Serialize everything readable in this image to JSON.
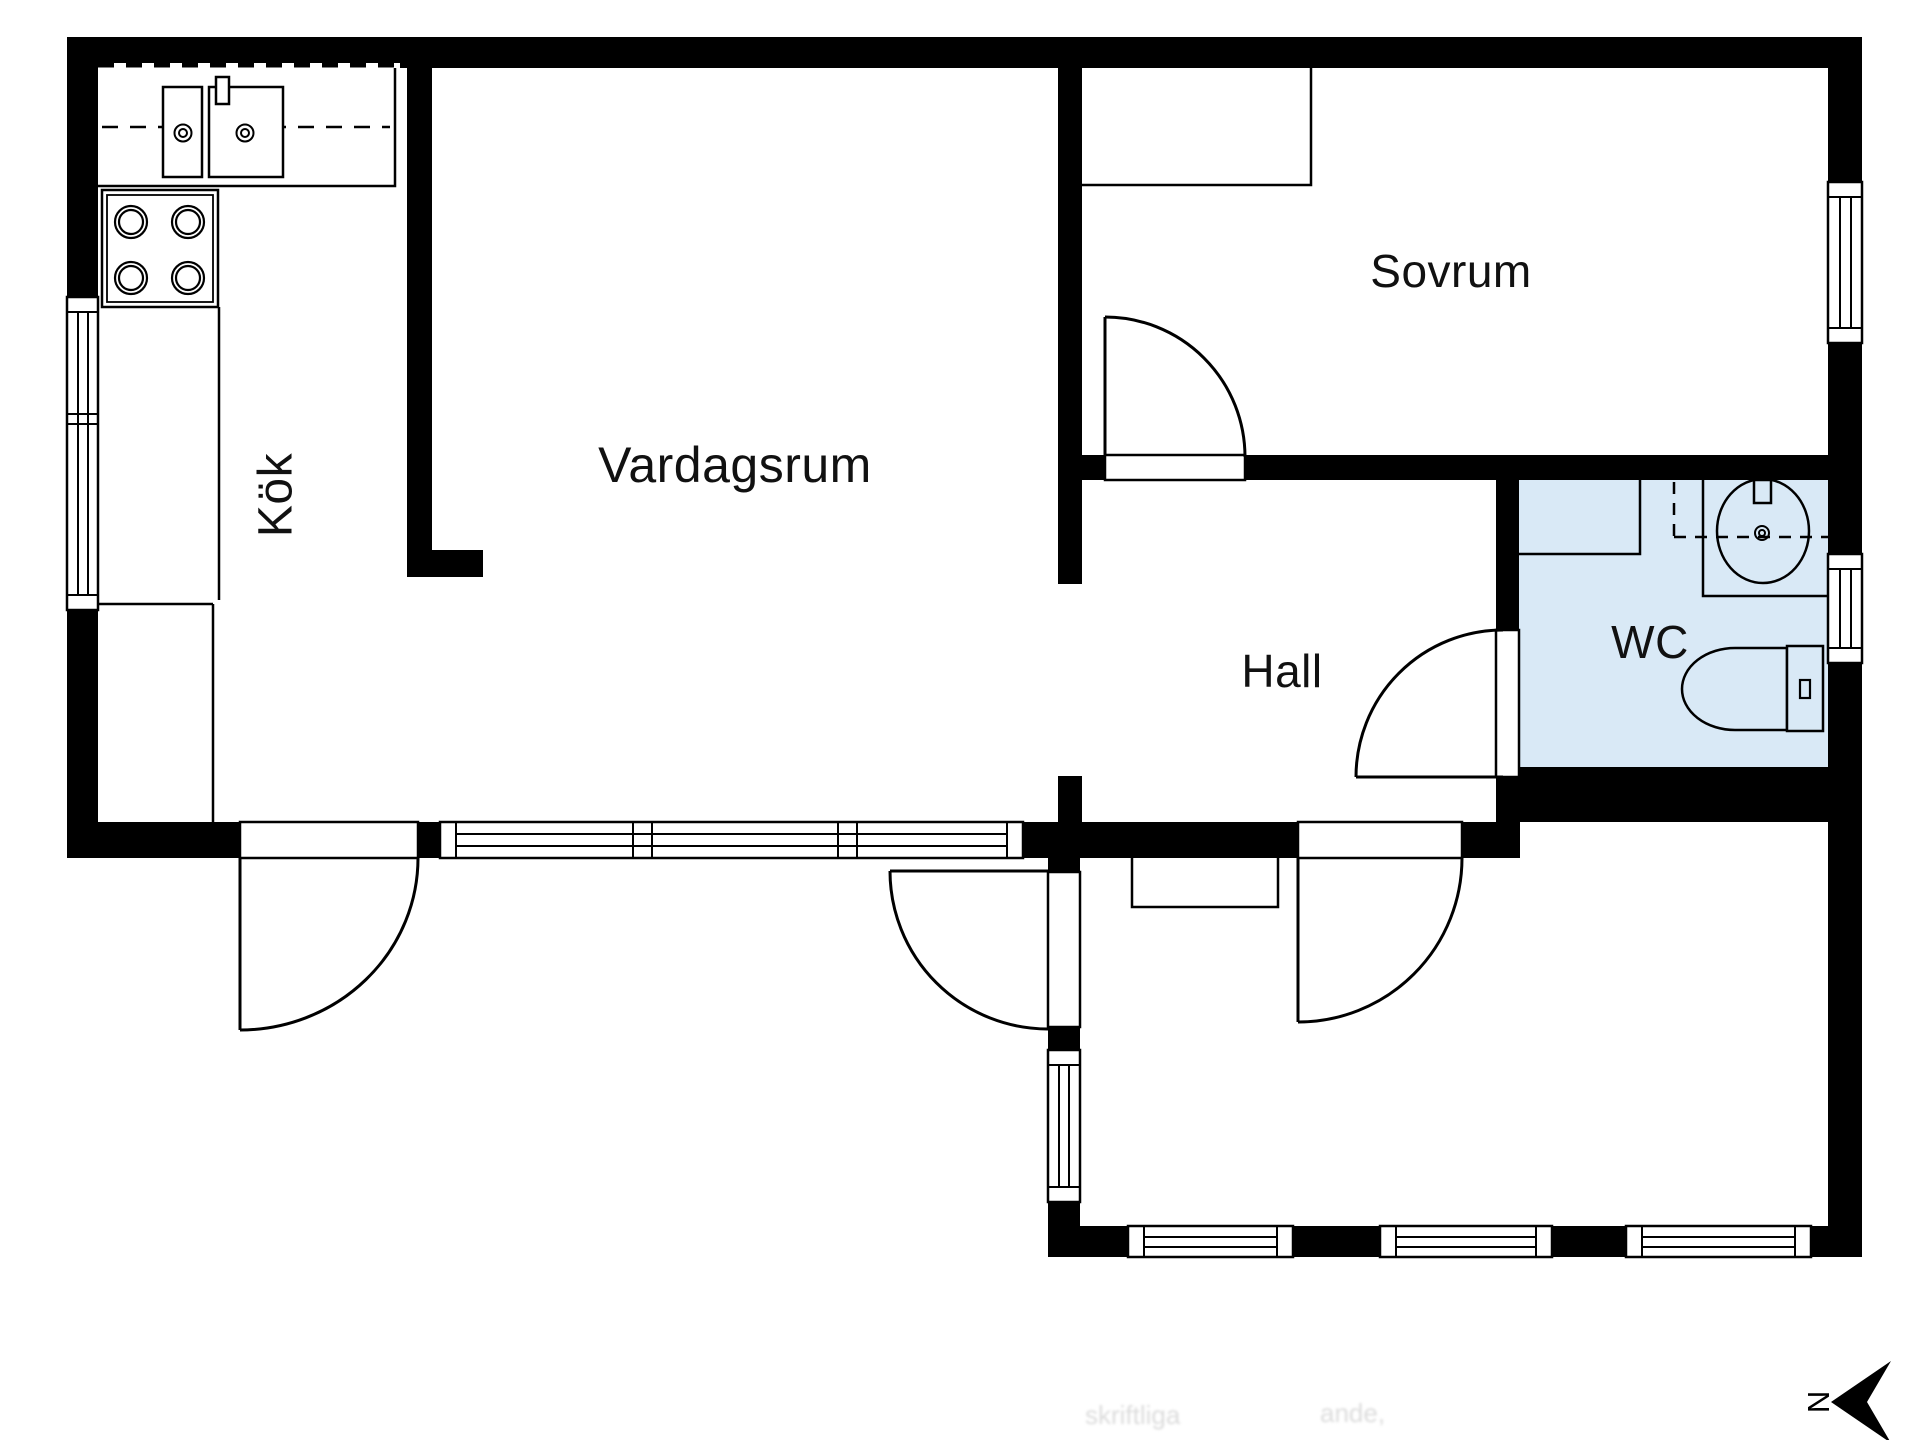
{
  "rooms": [
    {
      "id": "kok",
      "label": "Kök"
    },
    {
      "id": "vardagsrum",
      "label": "Vardagsrum"
    },
    {
      "id": "sovrum",
      "label": "Sovrum"
    },
    {
      "id": "hall",
      "label": "Hall"
    },
    {
      "id": "wc",
      "label": "WC"
    }
  ],
  "compass": {
    "letter": "N"
  },
  "watermark": {
    "fragment1": "skriftliga",
    "fragment2": "ande,"
  },
  "colors": {
    "wall": "#000000",
    "background": "#ffffff",
    "wc_floor": "#d9e9f6",
    "line": "#000000"
  }
}
